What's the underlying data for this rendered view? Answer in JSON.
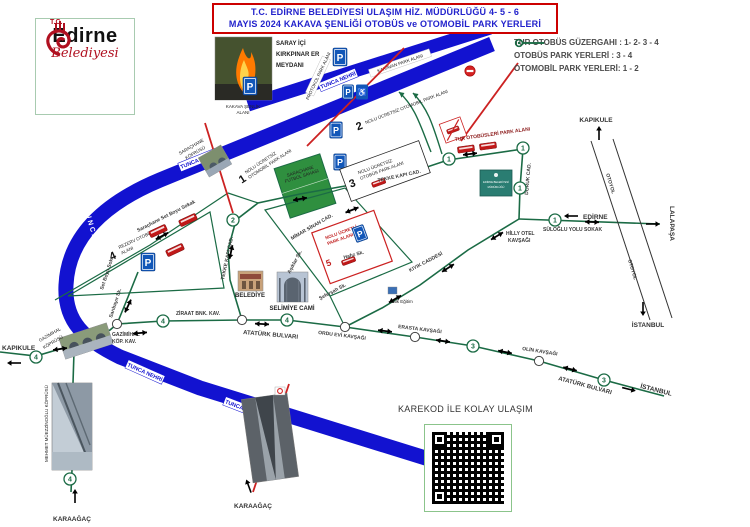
{
  "header": {
    "line1": "T.C. EDİRNE BELEDİYESİ ULAŞIM HİZ. MÜDÜRLÜĞÜ 4- 5 - 6",
    "line2": "MAYIS 2024 KAKAVA ŞENLİĞİ OTOBÜS ve OTOMOBİL PARK YERLERİ"
  },
  "logo": {
    "tc": "T.C.",
    "city": "Edirne",
    "municipality": "Belediyesi"
  },
  "legend": {
    "items": [
      {
        "label": "TUR OTOBÜS GÜZERGAHI : 1- 2- 3 - 4"
      },
      {
        "label": "OTOBÜS PARK YERLERİ : 3 - 4"
      },
      {
        "label": "OTOMOBİL PARK YERLERİ: 1 - 2"
      }
    ]
  },
  "colors": {
    "accent_red": "#cc0000",
    "title_blue": "#2222cc",
    "river_blue": "#1212d0",
    "route_green": "#1b6b45",
    "closed_red": "#cc2222",
    "parking_blue": "#1257b8"
  },
  "map": {
    "areas": {
      "saray1": "SARAY İÇİ",
      "saray2": "KIRKPINAR ER",
      "saray3": "MEYDANI",
      "kakava1": "KAKAVA ŞENLİK",
      "kakava2": "ALANI",
      "karavan": "KARAVAN PARK ALANI",
      "protokol": "PROTOKOL PARK ALANI",
      "nolu1_num": "1",
      "nolu1_l1": "NOLU ÜCRETSİZ",
      "nolu1_l2": "OTOMOBİL PARK ALANI",
      "nolu2_num": "2",
      "nolu2_text": "NOLU ÜCRETSİZ OTOMOBİL PARK ALANI",
      "nolu3_num": "3",
      "nolu3_l1": "NOLU ÜCRETSİZ",
      "nolu3_l2": "OTOBÜS PARK ALANI",
      "rezerv_num": "4",
      "rezerv_l1": "REZERV OTOBÜS PARK",
      "rezerv_l2": "ALANI",
      "ucretli_num": "5",
      "ucretli_l1": "NOLU ÜCRETLİ",
      "ucretli_l2": "PARK ALANI",
      "tur_otobus": "TUR OTOBÜSLERİ PARK ALANI",
      "futbol1": "SARAÇHANE",
      "futbol2": "FUTBOL SAHASI",
      "halk_egitim": "Halk Eğitim"
    },
    "rivers": {
      "tunca": "TUNCA NEHRİ"
    },
    "streets": {
      "set_sokak": "Saraçhane Set Boyu Sokak",
      "set_boyu": "Set Boyu Sok.",
      "tekke": "TEKKE KAPI CAD.",
      "mimar": "MİMAR SİNAN CAD.",
      "asiklar": "Aşıklar Sk.",
      "hafiz": "Hafız Sk.",
      "sefersah": "Şeferşah Sk.",
      "ataturk": "ATATÜRK BULVARI",
      "kiyik": "KIYIK CADDESİ",
      "suloglu": "SÜLOĞLU YOLU SOKAK",
      "doruk": "DORUK CAD.",
      "otoyol": "OTOYOL",
      "saribayir": "Sarıbayır Sk."
    },
    "junctions": {
      "ordu": "ORDU EVİ KAVŞAĞI",
      "ziraat": "ZİRAAT BNK. KAV.",
      "gazimihal1": "GAZİMİHAL",
      "gazimihal2": "KÖP. KAV.",
      "hilly1": "HİLLY OTEL",
      "hilly2": "KAVŞAĞI",
      "erasta": "ERASTA KAVŞAĞI",
      "olin": "OLİN KAVŞAĞI"
    },
    "bridges": {
      "sarachane1": "SARAÇHANE",
      "sarachane2": "KÖPRÜSÜ",
      "gazimihal1": "GAZİMİHAL",
      "gazimihal2": "KÖPRÜSÜ",
      "mehmet": "MEHMET MÜEZZİNOĞLU KÖPRÜSÜ"
    },
    "destinations": {
      "kapikule": "KAPIKULE",
      "edirne": "EDİRNE",
      "lalapasa": "LALAPAŞA",
      "istanbul": "İSTANBUL",
      "karaagac": "KARAAĞAÇ"
    },
    "landmarks": {
      "belediye": "BELEDİYE",
      "selimiye": "SELİMİYE CAMİ"
    },
    "qr": {
      "caption": "KAREKOD İLE KOLAY ULAŞIM"
    },
    "signs": {
      "p": "P",
      "handicap": "♿",
      "sign1": "EDİRNE BELEDİYESİ",
      "sign2": "MÜDÜRLÜĞÜ"
    },
    "route_numbers": {
      "r1": "1",
      "r2": "2",
      "r3": "3",
      "r4": "4"
    }
  }
}
